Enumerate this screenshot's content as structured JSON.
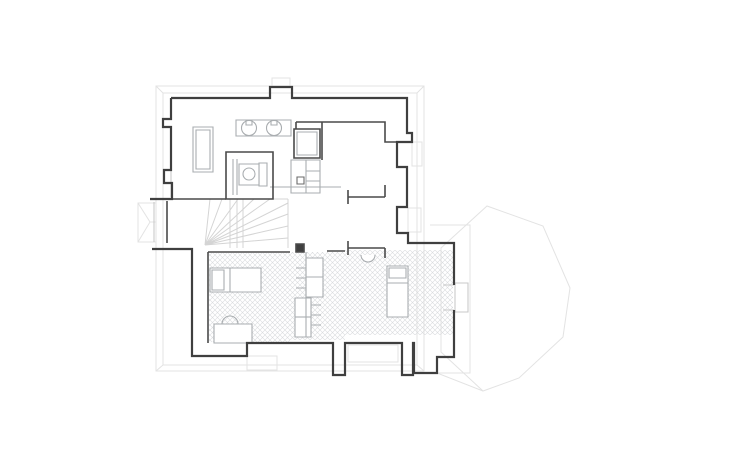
{
  "page": {
    "kind": "architectural-floor-plan",
    "background": "#ffffff",
    "width": 736,
    "height": 460
  },
  "colors": {
    "wall": "#3f3f3f",
    "interior_wall": "#4a4a4a",
    "furniture": "#a9adb0",
    "window": "#c9c9c9",
    "roof": "#e3e3e3",
    "stair": "#d4d4d4",
    "hatch_line": "#d9dbdd",
    "paper": "#ffffff"
  },
  "hatch": {
    "size": 5,
    "line_width": 0.6
  },
  "layers": [
    {
      "name": "roof-outline-layer",
      "stroke": "#e3e3e3",
      "width": 1,
      "fill": "none",
      "elements": [
        {
          "name": "eave-outer",
          "d": "M156,86 H424 V371 H156 Z"
        },
        {
          "name": "eave-inner",
          "d": "M163,93 H417 V365 H163 Z"
        },
        {
          "name": "eave-corner-diagonals",
          "d": "M156,86 L163,93 M424,86 L417,93 M156,371 L163,365 M424,371 L417,365"
        },
        {
          "name": "dormer-roof",
          "d": "M138,203 H156 V242 H138 Z M138,203 L150,222 M138,242 L150,222 M150,222 H156"
        },
        {
          "name": "tower-octagon-roof",
          "d": "M441,248 L487,206 L543,226 L570,288 L563,337 L519,378 L483,391 L441,352 Z"
        },
        {
          "name": "tower-wall-frame",
          "d": "M430,225 H470 V373 H430"
        },
        {
          "name": "tower-valley-line",
          "d": "M437,373 L483,391"
        },
        {
          "name": "chimney-ghost-top",
          "d": "M272,78 H290 V87 H272 Z"
        },
        {
          "name": "pilaster-ghost-upper",
          "d": "M412,142 H422 V166 H412 Z"
        },
        {
          "name": "pilaster-ghost-lower",
          "d": "M408,208 H421 V232 H408 Z"
        },
        {
          "name": "chimney-ghost-bottom-left",
          "d": "M247,356 H277 V370 H247 Z"
        },
        {
          "name": "chimney-ghost-bottom-right",
          "d": "M348,345 H398 V362 H348 Z"
        }
      ]
    },
    {
      "name": "staircase-layer",
      "stroke": "#d4d4d4",
      "width": 1,
      "fill": "none",
      "elements": [
        {
          "name": "stair-boundary",
          "d": "M288,199 V248 M192,199 H288"
        },
        {
          "name": "stair-upper-flight",
          "d": "M224,199 H243 V248 M230,199 V248 M237,199 V248"
        },
        {
          "name": "stair-winder-treads",
          "d": "M205,245 L210,199 M205,245 L222,199 M205,245 L238,199 M205,245 L254,199 M205,245 L270,199 M205,245 L288,203 M205,245 L288,214 M205,245 L288,226 M205,245 L288,238"
        }
      ]
    },
    {
      "name": "hatched-floor-layer",
      "stroke": "none",
      "width": 0,
      "fill": "url(#hatch)",
      "elements": [
        {
          "name": "floor-bedroom-west",
          "d": "M209,253 H290 V342 H209 Z"
        },
        {
          "name": "floor-cabinet-strip",
          "d": "M290,252 H345 V340 H290 Z"
        },
        {
          "name": "floor-bedroom-east",
          "d": "M345,250 H453 V335 H345 Z"
        }
      ]
    },
    {
      "name": "furniture-layer",
      "stroke": "#a9adb0",
      "width": 1.1,
      "fill": "none",
      "elements": [
        {
          "name": "wardrobe",
          "d": "M193,127 H213 V172 H193 Z",
          "fill": "#ffffff"
        },
        {
          "name": "wardrobe-inner-line",
          "d": "M196,130 H210 V169 H196 Z"
        },
        {
          "name": "basin-counter",
          "d": "M236,120 H291 V136 H236 Z",
          "fill": "#ffffff"
        },
        {
          "name": "wash-basin-1",
          "d": "M241.5,128 a7.5,7.5 0 1,0 15,0 a7.5,7.5 0 1,0 -15,0",
          "fill": "#ffffff"
        },
        {
          "name": "wash-basin-2",
          "d": "M266.5,128 a7.5,7.5 0 1,0 15,0 a7.5,7.5 0 1,0 -15,0",
          "fill": "#ffffff"
        },
        {
          "name": "basin-tap-1",
          "d": "M246,120 H252 V125 H246 Z"
        },
        {
          "name": "basin-tap-2",
          "d": "M271,120 H277 V125 H271 Z"
        },
        {
          "name": "toilet-cistern",
          "d": "M259,163 H267 V186 H259 Z",
          "fill": "#ffffff"
        },
        {
          "name": "toilet-body",
          "d": "M239,164 H259 V185 H239 Z",
          "fill": "#ffffff"
        },
        {
          "name": "toilet-bowl",
          "d": "M243,174 a6,6 0 1,0 12,0 a6,6 0 1,0 -12,0"
        },
        {
          "name": "shower-partition-lines",
          "d": "M233,159 V195 M237,159 V195"
        },
        {
          "name": "fridge-inner-line",
          "d": "M297,132 H317 V155 H297 Z"
        },
        {
          "name": "kitchen-block",
          "d": "M291,160 H320 V193 H291 Z",
          "fill": "#ffffff"
        },
        {
          "name": "kitchen-dividers",
          "d": "M306,160 V193 M306,171 H320 M306,181 H320"
        },
        {
          "name": "kitchen-sink",
          "d": "M297,177 H304 V184 H297 Z",
          "stroke": "#6b6b6b"
        },
        {
          "name": "kitchen-counter-line",
          "d": "M270,187 H341"
        },
        {
          "name": "bed-west",
          "d": "M210,268 H261 V292 H210 Z",
          "fill": "#ffffff"
        },
        {
          "name": "bed-west-pillow",
          "d": "M212,270 H224 V290 H212 Z"
        },
        {
          "name": "bed-west-blanket-line",
          "d": "M230,268 V292"
        },
        {
          "name": "desk-west",
          "d": "M214,324 H252 V343 H214 Z",
          "fill": "#ffffff"
        },
        {
          "name": "desk-basin-arc",
          "d": "M222,324 A8,8 0 0 1 238,324"
        },
        {
          "name": "hall-basin-arc",
          "d": "M361,255 A7,7 0 0 0 375,255",
          "fill": "#ffffff"
        },
        {
          "name": "bed-east",
          "d": "M387,266 H408 V317 H387 Z",
          "fill": "#ffffff"
        },
        {
          "name": "bed-east-pillow",
          "d": "M389,268 H406 V278 H389 Z"
        },
        {
          "name": "bed-east-blanket-line",
          "d": "M387,283 H408"
        },
        {
          "name": "cabinet-upper",
          "d": "M306,258 H323 V297 H306 Z",
          "fill": "#ffffff"
        },
        {
          "name": "cabinet-upper-shelf",
          "d": "M306,277 H323"
        },
        {
          "name": "cabinet-lower",
          "d": "M295,298 H311 V337 H295 Z",
          "fill": "#ffffff"
        },
        {
          "name": "cabinet-lower-shelf",
          "d": "M295,317 H311"
        },
        {
          "name": "cabinet-spine",
          "d": "M306,252 V337"
        },
        {
          "name": "cabinet-shelf-ticks",
          "d": "M296,268 H306 M296,278 H306 M296,288 H306 M311,305 H321 M311,315 H321 M311,325 H321"
        },
        {
          "name": "bay-window",
          "d": "M455,283 H468 V312 H455 Z",
          "stroke": "#c9c9c9"
        },
        {
          "name": "bay-window-jambs",
          "d": "M443,285 H454 M443,310 H454",
          "stroke": "#c9c9c9"
        },
        {
          "name": "stair-window",
          "d": "M171,165 V197",
          "stroke": "#c9c9c9"
        },
        {
          "name": "balcony-window",
          "d": "M154,202 V242",
          "stroke": "#c9c9c9"
        }
      ]
    },
    {
      "name": "interior-walls-layer",
      "stroke": "#4a4a4a",
      "width": 1.6,
      "fill": "none",
      "elements": [
        {
          "name": "partition-kitchen",
          "d": "M322,122 V160 M296,122 H322 M296,122 V129"
        },
        {
          "name": "room-north-inner-wall",
          "d": "M322,122 H385 V142 H397"
        },
        {
          "name": "bathroom-walls",
          "d": "M226,152 H273 V199 H226 Z"
        },
        {
          "name": "bathroom-south-wall",
          "d": "M172,199 H226"
        },
        {
          "name": "fridge-unit",
          "d": "M294,129 H320 V158 H294 Z"
        },
        {
          "name": "hall-wall-upper-T",
          "d": "M348,190 V204 M348,197 H385 M385,185 V197"
        },
        {
          "name": "hall-wall-lower-T",
          "d": "M348,241 V255 M348,248 H385 M385,248 V258"
        },
        {
          "name": "bedroom-north-wall-west",
          "d": "M208,252 H290"
        },
        {
          "name": "bedroom-north-wall-east",
          "d": "M327,251 H345"
        },
        {
          "name": "bedroom-west-wall",
          "d": "M208,252 V343"
        },
        {
          "name": "stair-bay-spine-wall",
          "d": "M167,201 V243"
        },
        {
          "name": "structural-column",
          "d": "M296,244 H304 V252 H296 Z",
          "fill": "#3f3f3f"
        }
      ]
    },
    {
      "name": "exterior-walls-layer",
      "stroke": "#3f3f3f",
      "width": 2.2,
      "fill": "none",
      "elements": [
        {
          "name": "outer-wall-top-right",
          "d": "M171,98 H270 V87 H292 V98 H407 V133 H412 V142 H397 V167 H407 V207 H397 V233 H408 V243 H454 V285"
        },
        {
          "name": "outer-wall-bottom",
          "d": "M454,310 V357 H437 V373 H414 V343 H413 V375 H402 V343 H345 V375 H333 V343 H247 V356 H192 V249 H152"
        },
        {
          "name": "outer-wall-left",
          "d": "M171,98 V119 H163 V127 H171 V170 H164 V183 H172 V199 H150"
        }
      ]
    }
  ]
}
